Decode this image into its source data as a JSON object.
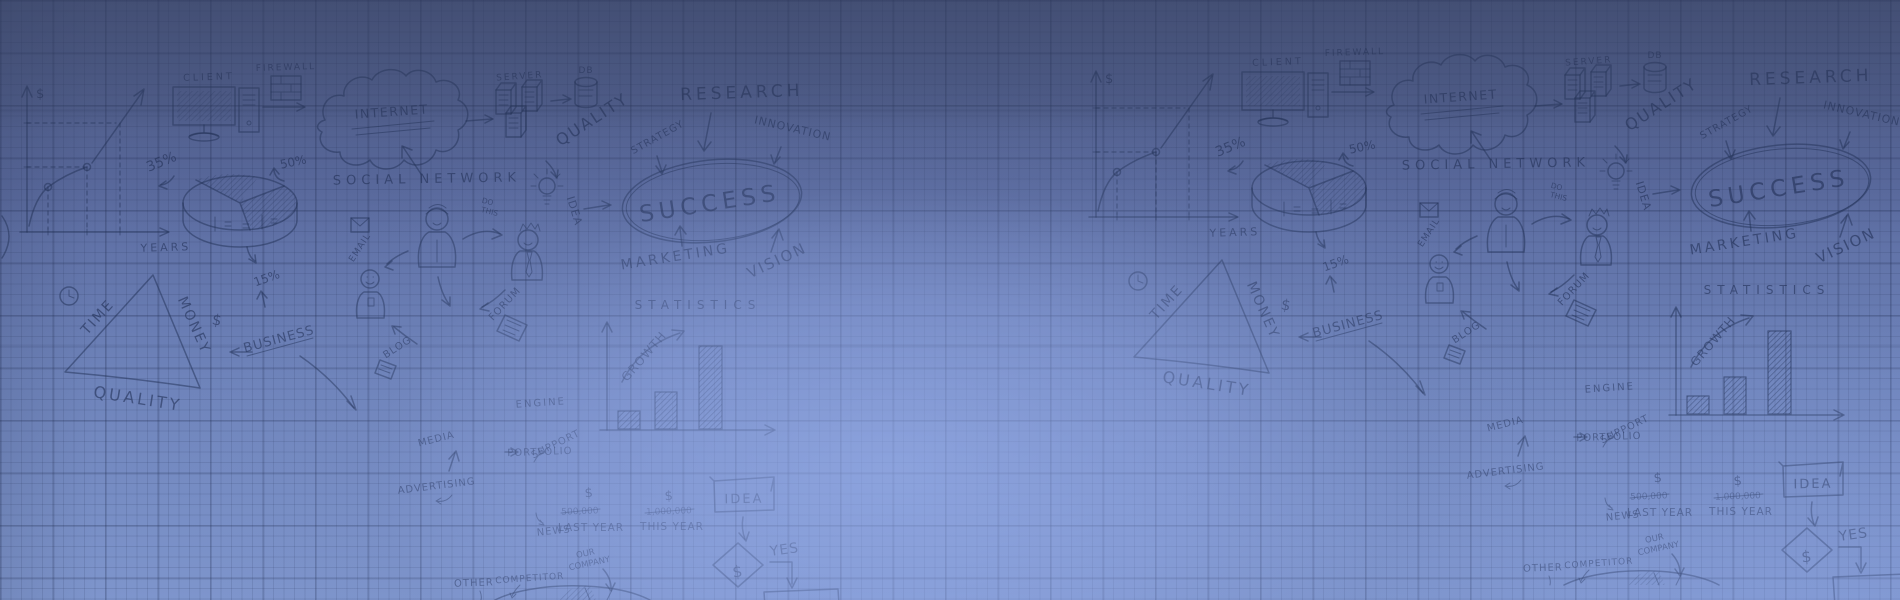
{
  "canvas": {
    "width_px": 1900,
    "height_px": 600
  },
  "theme": {
    "base_top": "#505d87",
    "base_bottom": "#7e95cc",
    "center_glow": "#9ab1ee",
    "top_shade": "#343e5e",
    "grid_line": "#1c284b",
    "doodle_ink": "#20335f",
    "tile_repeat_offset_x": 1069,
    "tile_repeat_offset_y": -15
  },
  "doodles": {
    "line_chart": {
      "y_axis": "$",
      "x_axis": "YEARS",
      "pct35": "35%",
      "pct50": "50%"
    },
    "client": "CLIENT",
    "firewall": "FIREWALL",
    "internet": "INTERNET",
    "server": "SERVER",
    "db": "DB",
    "quality_diag": "QUALITY",
    "research": "RESEARCH",
    "innovation": "INNOVATION",
    "strategy": "STRATEGY",
    "success": "SUCCESS",
    "vision": "VISION",
    "marketing": "MARKETING",
    "social_network": "SOCIAL NETWORK",
    "email": "EMAIL",
    "do_this": {
      "line1": "DO",
      "line2": "THIS"
    },
    "idea_side": "IDEA",
    "forum": "FORUM",
    "blog": "BLOG",
    "triangle": {
      "time": "TIME",
      "money": "MONEY",
      "quality": "QUALITY",
      "dollar": "$",
      "pct15": "15%"
    },
    "business": "BUSINESS",
    "statistics": "STATISTICS",
    "growth": "GROWTH",
    "engine": "ENGINE",
    "support": "SUPPORT",
    "media": "MEDIA",
    "advertising": "ADVERTISING",
    "portfolio": "PORTFOLIO",
    "news": "NEWS",
    "money_row": {
      "dollar_a": "$",
      "dollar_b": "$",
      "last_amount": "500,000",
      "last_label": "LAST YEAR",
      "this_amount": "1,000,000",
      "this_label": "THIS YEAR"
    },
    "flow": {
      "idea": "IDEA",
      "dollar": "$",
      "yes": "YES"
    },
    "bottom_pie": {
      "our_company": {
        "line1": "OUR",
        "line2": "COMPANY"
      },
      "competitor": "COMPETITOR",
      "other": "OTHER"
    }
  }
}
